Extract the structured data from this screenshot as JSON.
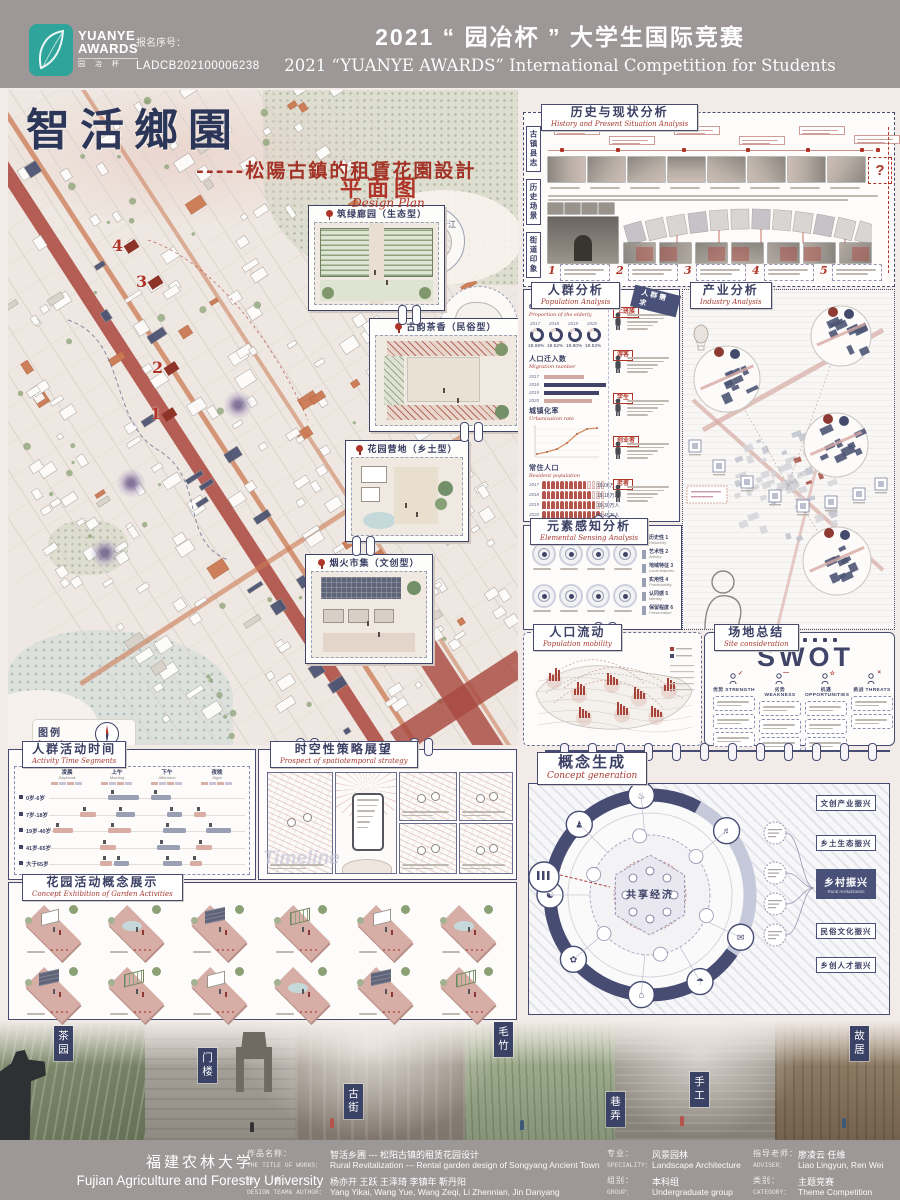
{
  "header": {
    "brand_top": "YUANYE",
    "brand_bottom": "AWARDS",
    "brand_cn": "园 冶 杯",
    "entry_label": "报名序号：",
    "entry_no": "LADCB202100006238",
    "title_cn": "2021 “ 园冶杯 ” 大学生国际竞赛",
    "title_en": "2021 “YUANYE AWARDS” International Competition for Students"
  },
  "title_block": {
    "main": "智活鄉園",
    "sub": "-----松陽古鎮的租賃花園設計"
  },
  "plan": {
    "title_cn": "平面图",
    "title_en": "Design Plan",
    "inset_labels": [
      "浙江",
      "松阳"
    ],
    "markers": [
      "1",
      "2",
      "3",
      "4"
    ],
    "callouts": [
      "筑绿廊园（生态型）",
      "古韵茶香（民俗型）",
      "花园营地（乡土型）",
      "烟火市集（文创型）"
    ],
    "legend_title_cn": "图例",
    "legend_title_en": "Legend",
    "legend_items": [
      {
        "cn": "植物种植",
        "en": "Planting"
      },
      {
        "cn": "河流",
        "en": "Planting"
      },
      {
        "cn": "主道路",
        "en": "Main road"
      },
      {
        "cn": "次级路",
        "en": "Secondary road"
      },
      {
        "cn": "重点花区",
        "en": "Key blocks"
      },
      {
        "cn": "保护性古建",
        "en": "Protected building"
      },
      {
        "cn": "灰色空间",
        "en": "Grey spaces"
      },
      {
        "cn": "人群聚集点",
        "en": "Gathering places"
      }
    ]
  },
  "history": {
    "title_cn": "历史与现状分析",
    "title_en": "History and Present Situation Analysis",
    "side_tabs": [
      "古镇县志",
      "历史场景",
      "街道印象"
    ],
    "question_mark": "?",
    "photo_numbers": [
      "1",
      "2",
      "3",
      "4",
      "5"
    ]
  },
  "population": {
    "title_cn": "人群分析",
    "title_en": "Population Analysis",
    "ribbon": "人群需求",
    "elderly": {
      "cn": "60岁以上老年人占比",
      "en": "Proportion of the elderly",
      "years": [
        "2017",
        "2018",
        "2019",
        "2020"
      ],
      "values": [
        "18.69%",
        "19.52%",
        "19.80%",
        "19.52%"
      ]
    },
    "migration": {
      "cn": "人口迁入数",
      "en": "Migration number",
      "years": [
        "2017",
        "2018",
        "2019",
        "2020"
      ]
    },
    "urbanization": {
      "cn": "城镇化率",
      "en": "Urbanization rate"
    },
    "resident": {
      "cn": "常住人口",
      "en": "Resident population",
      "years": [
        "2017",
        "2018",
        "2019",
        "2020"
      ],
      "values": [
        "19.06万人",
        "19.18万人",
        "19.30万人",
        "19.45万人"
      ]
    },
    "personas": [
      "上班族",
      "游客",
      "学生",
      "创业者",
      "老者"
    ]
  },
  "industry": {
    "title_cn": "产业分析",
    "title_en": "Industry Analysis"
  },
  "sensing": {
    "title_cn": "元素感知分析",
    "title_en": "Elemental Sensing Analysis",
    "criteria": [
      {
        "cn": "历史性",
        "num": "1",
        "en": "Historicity"
      },
      {
        "cn": "艺术性",
        "num": "2",
        "en": "Artistry"
      },
      {
        "cn": "地域特征",
        "num": "3",
        "en": "Local features"
      },
      {
        "cn": "实用性",
        "num": "4",
        "en": "Practicability"
      },
      {
        "cn": "认同感",
        "num": "5",
        "en": "Identity"
      },
      {
        "cn": "保留程度",
        "num": "6",
        "en": "Preservation"
      }
    ]
  },
  "mobility": {
    "title_cn": "人口流动",
    "title_en": "Population mobility"
  },
  "swot": {
    "title_cn": "场地总结",
    "title_en": "Site consideration",
    "big": "SWOT",
    "columns": [
      {
        "cn": "优势",
        "en": "STRENGTH",
        "mark": "✓"
      },
      {
        "cn": "劣势",
        "en": "WEAKNESS",
        "mark": "—"
      },
      {
        "cn": "机遇",
        "en": "OPPORTUNITIES",
        "mark": "☆"
      },
      {
        "cn": "挑战",
        "en": "THREATS",
        "mark": "×"
      }
    ]
  },
  "activity": {
    "title_cn": "人群活动时间",
    "title_en": "Activity Time Segments",
    "periods": [
      {
        "cn": "凌晨",
        "en": "Daybreak"
      },
      {
        "cn": "上午",
        "en": "Morning"
      },
      {
        "cn": "下午",
        "en": "Afternoon"
      },
      {
        "cn": "夜晚",
        "en": "Night"
      }
    ],
    "groups": [
      "0岁-6岁",
      "7岁-18岁",
      "19岁-40岁",
      "41岁-65岁",
      "大于65岁"
    ]
  },
  "strategy": {
    "title_cn": "时空性策略展望",
    "title_en": "Prospect of spatiotemporal strategy",
    "watermark": "Timeline"
  },
  "garden": {
    "title_cn": "花园活动概念展示",
    "title_en": "Concept Exhibition of Garden Activities"
  },
  "concept": {
    "title_cn": "概念生成",
    "title_en": "Concept generation",
    "center": "共享经济",
    "boxes": [
      "文创产业振兴",
      "乡土生态振兴",
      "乡村振兴",
      "民俗文化振兴",
      "乡创人才振兴"
    ],
    "dark_en": "Rural revitalization"
  },
  "photo_strip": {
    "labels": [
      "茶园",
      "门楼",
      "古街",
      "毛竹",
      "巷弄",
      "手工",
      "故居"
    ]
  },
  "footer": {
    "university_cn": "福建农林大学",
    "university_en": "Fujian Agriculture and Forestry University",
    "credits": [
      {
        "cn_label": "作品名称：",
        "en_label": "THE TITLE OF WORKS：",
        "cn": "智活乡圃 --- 松阳古镇的租赁花园设计",
        "en": "Rural Revitalization --- Rental garden design of Songyang Ancient Town"
      },
      {
        "cn_label": "作　　者：",
        "en_label": "DESIGN TEAM& AUTHOR：",
        "cn": "杨亦开 王跃 王泽琦 李镇年 靳丹阳",
        "en": "Yang Yikai, Wang Yue, Wang Zeqi, Li Zhennian, Jin Danyang"
      },
      {
        "cn_label": "专业：",
        "en_label": "SPECIALITY：",
        "cn": "风景园林",
        "en": "Landscape Architecture"
      },
      {
        "cn_label": "组别：",
        "en_label": "GROUP：",
        "cn": "本科组",
        "en": "Undergraduate group"
      },
      {
        "cn_label": "指导老师：",
        "en_label": "ADVISER：",
        "cn": "廖凌云 任维",
        "en": "Liao Lingyun, Ren Wei"
      },
      {
        "cn_label": "类别：",
        "en_label": "CATEGORY：",
        "cn": "主题竞赛",
        "en": "Theme Competition"
      }
    ]
  }
}
